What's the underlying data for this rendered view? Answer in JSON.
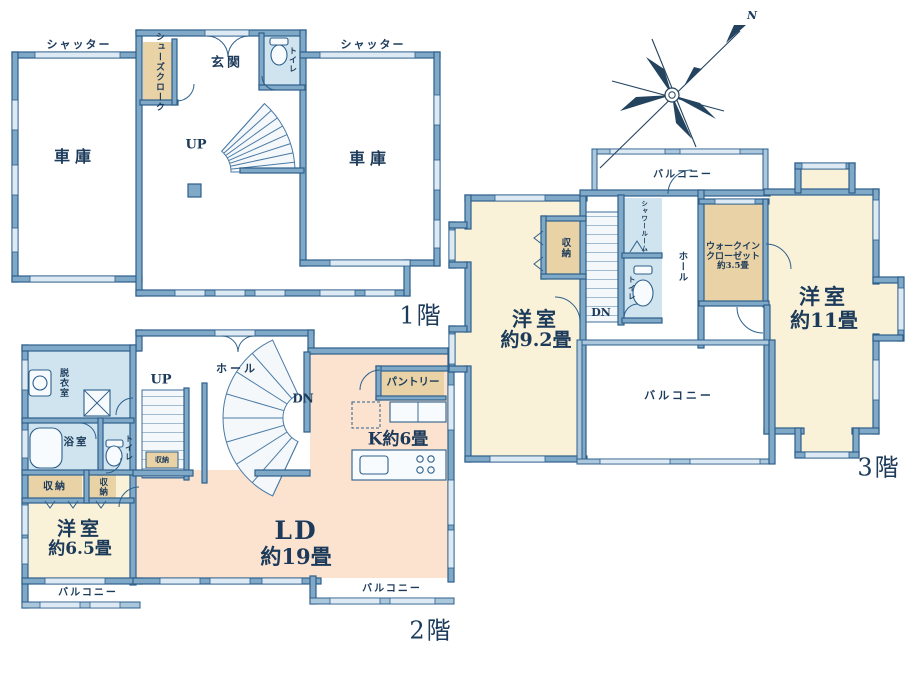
{
  "f1": {
    "floor_label": "1階",
    "shutter_left": "シャッター",
    "shutter_right": "シャッター",
    "garage_left": "車庫",
    "garage_right": "車庫",
    "shoes_cloak": "シューズクローク",
    "entrance": "玄関",
    "toilet": "トイレ",
    "up": "UP"
  },
  "f2": {
    "floor_label": "2階",
    "dressing_room": "脱衣室",
    "bath": "浴室",
    "toilet": "トイレ",
    "up": "UP",
    "dn": "DN",
    "hall": "ホール",
    "storage_under_stairs": "収納",
    "storage_left": "収納",
    "storage_right": "収納",
    "western_room_name": "洋室",
    "western_room_size": "約6.5畳",
    "ld_name": "LD",
    "ld_size": "約19畳",
    "kitchen": "K約6畳",
    "pantry": "パントリー",
    "balcony_left": "バルコニー",
    "balcony_right": "バルコニー"
  },
  "f3": {
    "floor_label": "3階",
    "balcony_top": "バルコニー",
    "western_room_92_name": "洋室",
    "western_room_92_size": "約9.2畳",
    "storage": "収納",
    "dn": "DN",
    "shower_room": "シャワールーム",
    "toilet": "トイレ",
    "hall": "ホール",
    "wic_line1": "ウォークイン",
    "wic_line2": "クローゼット",
    "wic_line3": "約3.5畳",
    "western_room_11_name": "洋室",
    "western_room_11_size": "約11畳",
    "balcony_main": "バルコニー"
  },
  "compass": {
    "north": "N"
  },
  "colors": {
    "wall_fill": "#7fa9c6",
    "wall_edge": "#2d5f8c",
    "room_cream": "#faf2d8",
    "room_peach": "#fbe3d0",
    "closet_tan": "#e9d3a6",
    "wet_blue": "#cfe4ee",
    "window_light": "#ddeaf4",
    "text_navy": "#1c3a5a"
  }
}
